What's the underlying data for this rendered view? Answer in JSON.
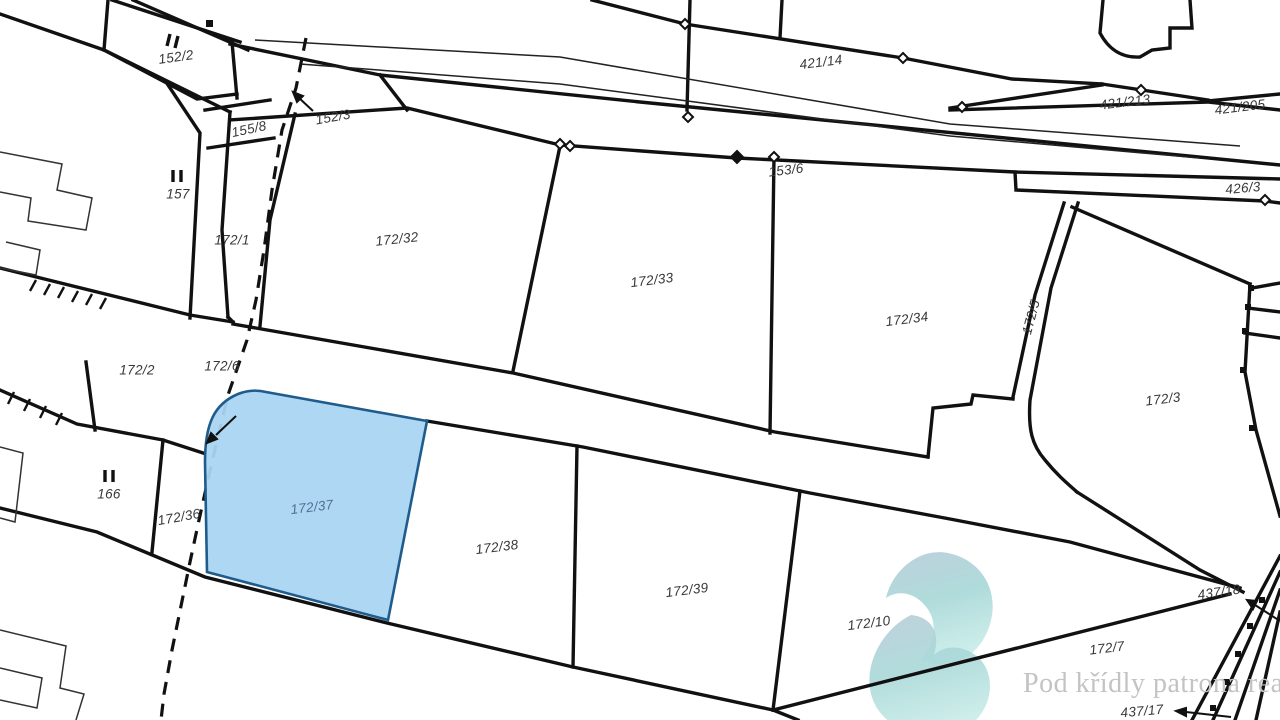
{
  "map": {
    "title": "cadastral parcel map",
    "highlighted_parcel": {
      "id": "172/37",
      "fill": "#aad5f2",
      "stroke": "#1f5c8b",
      "label_color": "#4f7296"
    },
    "line_color": "#111111",
    "label_color": "#383838",
    "parcel_labels": [
      {
        "text": "152/2",
        "x": 176,
        "y": 57,
        "rot": -8
      },
      {
        "text": "155/8",
        "x": 249,
        "y": 129,
        "rot": -12
      },
      {
        "text": "152/3",
        "x": 333,
        "y": 117,
        "rot": -10
      },
      {
        "text": "157",
        "x": 178,
        "y": 194,
        "rot": 0
      },
      {
        "text": "421/14",
        "x": 821,
        "y": 62,
        "rot": -7
      },
      {
        "text": "153/6",
        "x": 786,
        "y": 170,
        "rot": -7
      },
      {
        "text": "421/213",
        "x": 1125,
        "y": 102,
        "rot": -7
      },
      {
        "text": "421/205",
        "x": 1240,
        "y": 107,
        "rot": -7
      },
      {
        "text": "426/3",
        "x": 1243,
        "y": 188,
        "rot": -5
      },
      {
        "text": "172/1",
        "x": 232,
        "y": 240,
        "rot": 0
      },
      {
        "text": "172/32",
        "x": 397,
        "y": 239,
        "rot": -6
      },
      {
        "text": "172/33",
        "x": 652,
        "y": 280,
        "rot": -7
      },
      {
        "text": "172/34",
        "x": 907,
        "y": 319,
        "rot": -7
      },
      {
        "text": "172/5",
        "x": 1031,
        "y": 317,
        "rot": -75
      },
      {
        "text": "172/3",
        "x": 1163,
        "y": 399,
        "rot": -7
      },
      {
        "text": "172/2",
        "x": 137,
        "y": 370,
        "rot": 0
      },
      {
        "text": "172/6",
        "x": 222,
        "y": 366,
        "rot": 0
      },
      {
        "text": "166",
        "x": 109,
        "y": 494,
        "rot": 0
      },
      {
        "text": "172/36",
        "x": 179,
        "y": 517,
        "rot": -10
      },
      {
        "text": "172/37",
        "x": 312,
        "y": 507,
        "rot": -7,
        "hl": true
      },
      {
        "text": "172/38",
        "x": 497,
        "y": 547,
        "rot": -7
      },
      {
        "text": "172/39",
        "x": 687,
        "y": 590,
        "rot": -7
      },
      {
        "text": "172/10",
        "x": 869,
        "y": 623,
        "rot": -7
      },
      {
        "text": "437/18",
        "x": 1219,
        "y": 592,
        "rot": -8
      },
      {
        "text": "172/7",
        "x": 1107,
        "y": 648,
        "rot": -7
      },
      {
        "text": "437/17",
        "x": 1142,
        "y": 711,
        "rot": -5
      }
    ]
  },
  "watermark": {
    "text": "Pod křídly patrona reality",
    "color": "#c3c3c3"
  },
  "logo": {
    "name": "pod-kridly-patrona-realty-logo",
    "gradient_top": "#b7ccd9",
    "gradient_mid": "#a9d8d8",
    "gradient_bottom": "#c8ece8"
  }
}
